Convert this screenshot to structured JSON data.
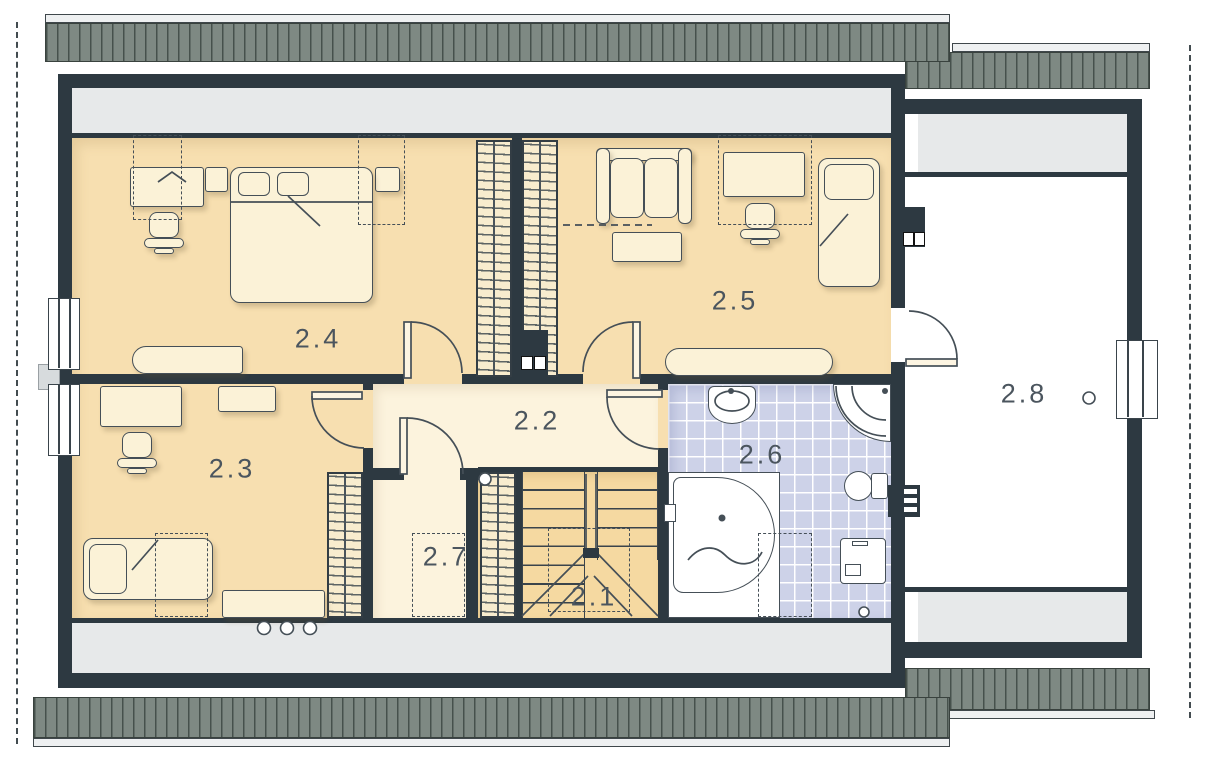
{
  "rooms": [
    {
      "id": "room-2-1",
      "label": "2.1"
    },
    {
      "id": "room-2-2",
      "label": "2.2"
    },
    {
      "id": "room-2-3",
      "label": "2.3"
    },
    {
      "id": "room-2-4",
      "label": "2.4"
    },
    {
      "id": "room-2-5",
      "label": "2.5"
    },
    {
      "id": "room-2-6",
      "label": "2.6"
    },
    {
      "id": "room-2-7",
      "label": "2.7"
    },
    {
      "id": "room-2-8",
      "label": "2.8"
    }
  ],
  "colors": {
    "wall": "#2d3941",
    "roof": "#7e8983",
    "roof_line": "#46514c",
    "floor_bedroom": "#f7dfb0",
    "floor_hall": "#fcf3dd",
    "floor_stairs": "#f5d9a1",
    "floor_bath": "#cdd2e8",
    "knee_area": "#e7e9ea",
    "furniture": "#fbf2d7",
    "outline": "#454f57"
  }
}
